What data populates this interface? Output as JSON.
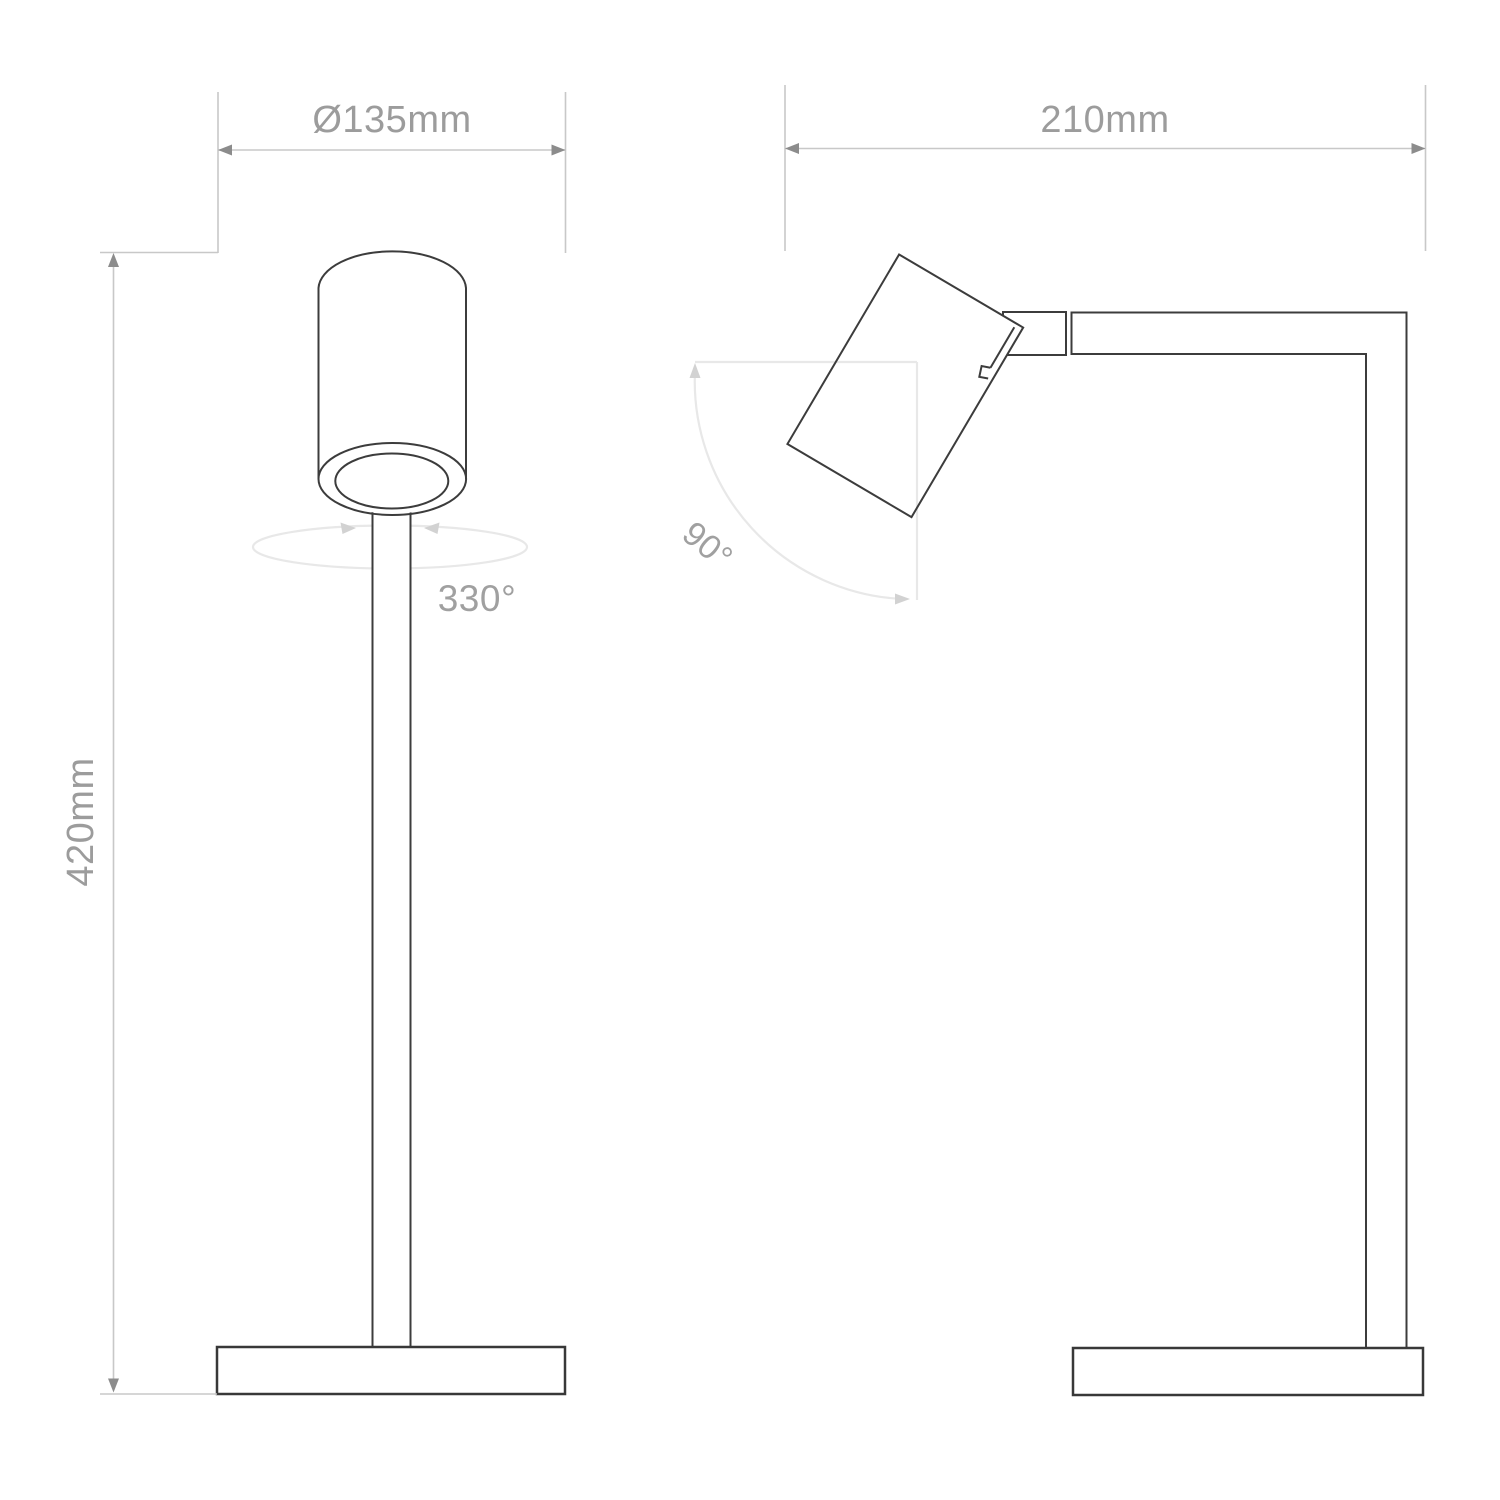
{
  "page": {
    "title": "Lamp technical dimension drawing",
    "background": "#ffffff"
  },
  "views": {
    "front": {
      "diameter_label": "Ø135mm",
      "height_label": "420mm",
      "swivel_label": "330°"
    },
    "side": {
      "depth_label": "210mm",
      "tilt_label": "90°"
    }
  },
  "dimensions": {
    "base_diameter": "Ø135mm",
    "overall_height": "420mm",
    "overall_depth": "210mm",
    "head_swivel_range": "330°",
    "head_tilt_range": "90°"
  },
  "colors": {
    "lamp_outline": "#3c3c3c",
    "dimension_lines": "#c8c8c8",
    "dimension_arrows": "#8c8c8c",
    "dimension_text": "#9c9c9c",
    "annotation_faint": "#e8e8e8",
    "annotation_arrows": "#d2d2d2"
  },
  "icons": {
    "arrow_left": "dimension-arrow-left",
    "arrow_right": "dimension-arrow-right",
    "arrow_up": "dimension-arrow-up",
    "arrow_down": "dimension-arrow-down"
  }
}
